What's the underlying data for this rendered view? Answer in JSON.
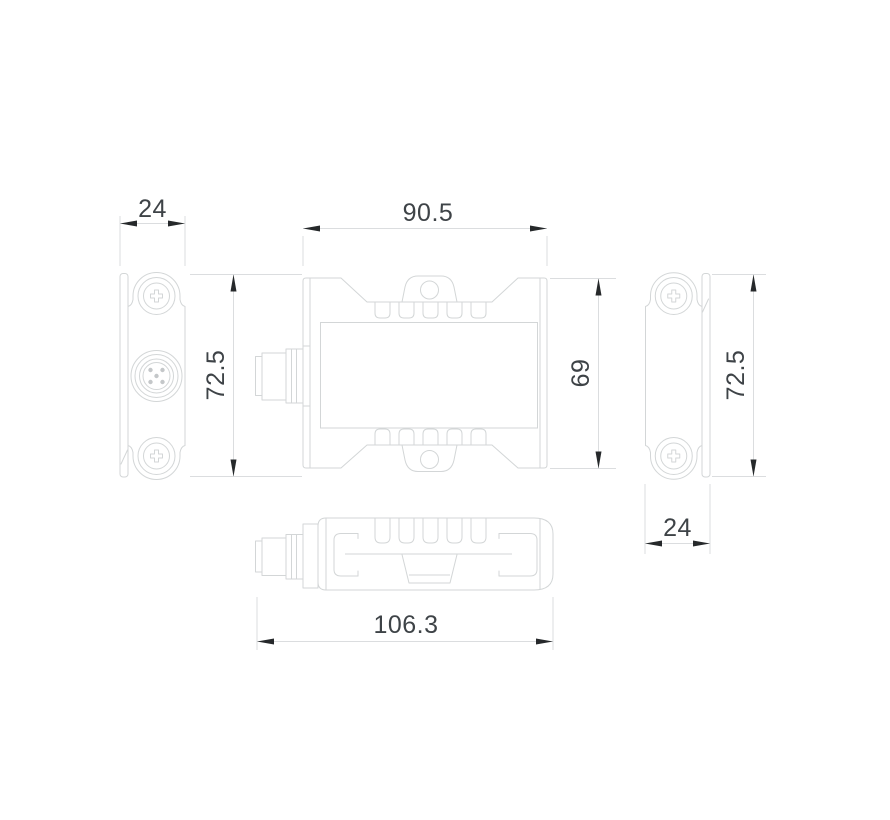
{
  "drawing": {
    "kind": "technical-dimension-drawing",
    "colors": {
      "background": "#ffffff",
      "line": "#d3d6d7",
      "dimline": "#dbdddf",
      "arrow": "#26292b",
      "text": "#3e4347",
      "hatch": "#c8cbcd",
      "pin": "#c4c7c9"
    },
    "dimensions": {
      "left_view_width": "24",
      "front_view_width": "90.5",
      "left_view_height": "72.5",
      "front_view_height": "69",
      "right_view_height": "72.5",
      "right_view_width": "24",
      "top_view_length": "106.3"
    }
  }
}
